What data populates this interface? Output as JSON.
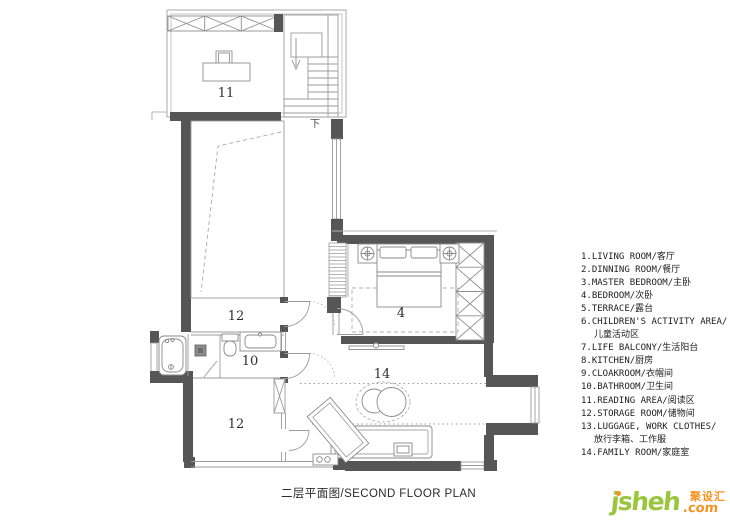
{
  "plan": {
    "room_labels": [
      {
        "room": "reading-area",
        "num": "11"
      },
      {
        "room": "storage-room-upper",
        "num": "12"
      },
      {
        "room": "bathroom",
        "num": "10"
      },
      {
        "room": "storage-room-lower",
        "num": "12"
      },
      {
        "room": "bedroom",
        "num": "4"
      },
      {
        "room": "family-room",
        "num": "14"
      },
      {
        "room": "stairs-direction",
        "num": "下"
      }
    ]
  },
  "legend": {
    "items": [
      {
        "line1": "1.LIVING ROOM/客厅"
      },
      {
        "line1": "2.DINNING ROOM/餐厅"
      },
      {
        "line1": "3.MASTER BEDROOM/主卧"
      },
      {
        "line1": "4.BEDROOM/次卧"
      },
      {
        "line1": "5.TERRACE/露台"
      },
      {
        "line1": "6.CHILDREN'S ACTIVITY AREA/",
        "line2": "儿童活动区"
      },
      {
        "line1": "7.LIFE BALCONY/生活阳台"
      },
      {
        "line1": "8.KITCHEN/厨房"
      },
      {
        "line1": "9.CLOAKROOM/衣帽间"
      },
      {
        "line1": "10.BATHROOM/卫生间"
      },
      {
        "line1": "11.READING AREA/阅读区"
      },
      {
        "line1": "12.STORAGE ROOM/储物间"
      },
      {
        "line1": "13.LUGGAGE, WORK CLOTHES/",
        "line2": "放行李箱、工作服"
      },
      {
        "line1": "14.FAMILY ROOM/家庭室"
      }
    ]
  },
  "footer": {
    "title": "二层平面图/SECOND FLOOR PLAN"
  },
  "logo": {
    "brand": "jsheh",
    "cn": "聚设汇",
    "tld": ".com",
    "brand_color": "#9bc53d",
    "accent_color": "#f6921e"
  }
}
